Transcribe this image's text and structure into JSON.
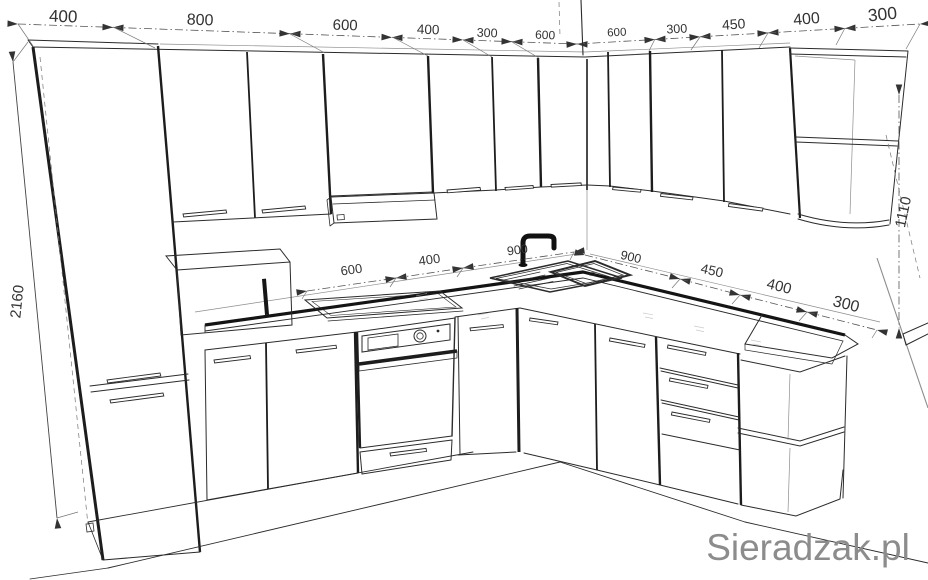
{
  "watermark": "Sieradzak.pl",
  "dimensions": {
    "wall_left_chain": [
      "400",
      "800",
      "600",
      "400",
      "300",
      "600"
    ],
    "wall_right_chain": [
      "600",
      "300",
      "450",
      "400",
      "300"
    ],
    "counter_left_chain": [
      "600",
      "400",
      "900"
    ],
    "counter_right_chain": [
      "900",
      "450",
      "400",
      "300"
    ],
    "cabinet_height": "2160",
    "right_height": "1110"
  },
  "colors": {
    "line": "#2b2b2b",
    "dimension": "#444444",
    "watermark": "#8c8c8c",
    "background": "#ffffff",
    "fixture": "#111111"
  }
}
